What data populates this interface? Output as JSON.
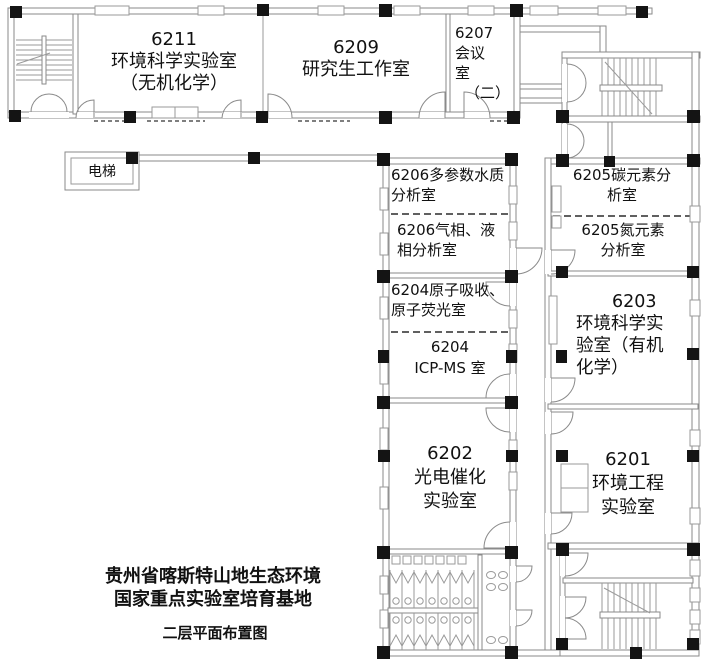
{
  "colors": {
    "wall": "#8a8a8a",
    "column": "#141414",
    "text": "#111111",
    "background": "#ffffff"
  },
  "labels": {
    "elevator": "电梯",
    "rooms": {
      "r6211": {
        "lines": [
          "6211",
          "环境科学实验室",
          "（无机化学）"
        ]
      },
      "r6209": {
        "lines": [
          "6209",
          "研究生工作室"
        ]
      },
      "r6207": {
        "lines": [
          "6207",
          "会议",
          "室",
          "（二）"
        ]
      },
      "r6206a": {
        "lines": [
          "6206多参数水质",
          "分析室"
        ]
      },
      "r6206b": {
        "lines": [
          "6206气相、液",
          "相分析室"
        ]
      },
      "r6205a": {
        "lines": [
          "6205碳元素分",
          "析室"
        ]
      },
      "r6205b": {
        "lines": [
          "6205氮元素",
          "分析室"
        ]
      },
      "r6204a": {
        "lines": [
          "6204原子吸收、",
          "原子荧光室"
        ]
      },
      "r6204b": {
        "lines": [
          "6204",
          "ICP-MS 室"
        ]
      },
      "r6203": {
        "lines": [
          "6203",
          "环境科学实",
          "验室（有机",
          "化学）"
        ]
      },
      "r6202": {
        "lines": [
          "6202",
          "光电催化",
          "实验室"
        ]
      },
      "r6201": {
        "lines": [
          "6201",
          "环境工程",
          "实验室"
        ]
      }
    },
    "footer": {
      "title_line1": "贵州省喀斯特山地生态环境",
      "title_line2": "国家重点实验室培育基地",
      "caption": "二层平面布置图"
    }
  }
}
